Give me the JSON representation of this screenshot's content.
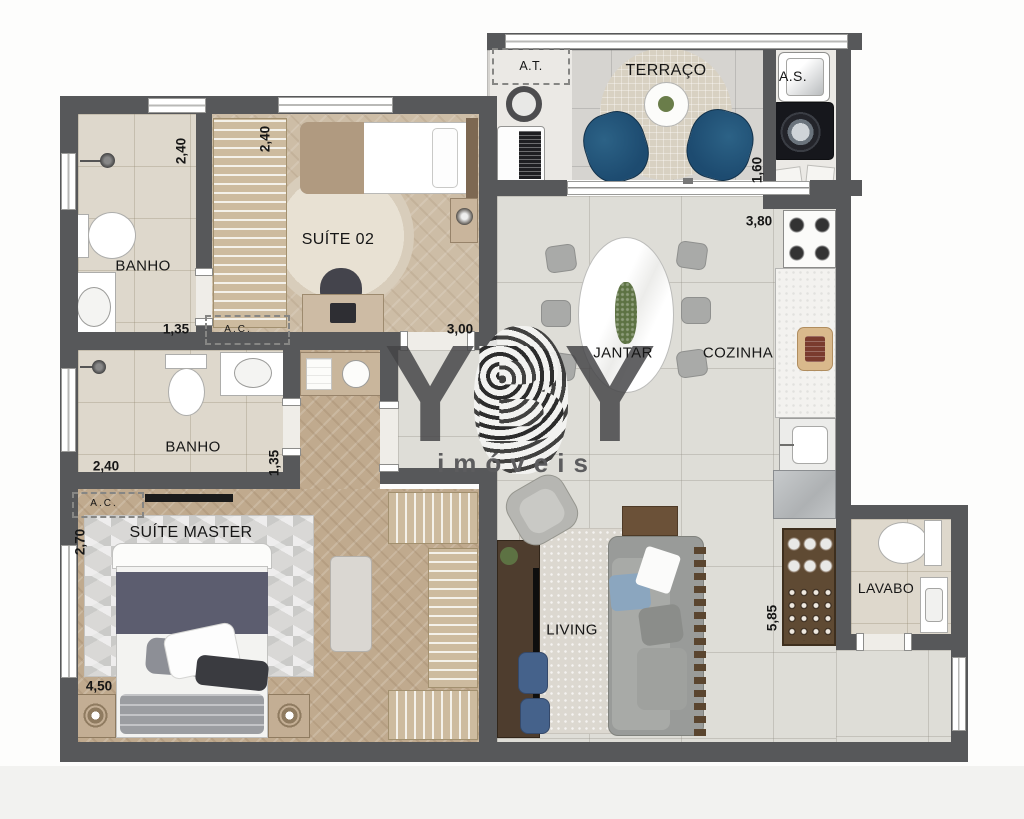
{
  "watermark": {
    "y1": "Y",
    "b": "B",
    "y2": "Y",
    "subtitle": "imóveis"
  },
  "rooms": {
    "banho1": "BANHO",
    "suite02": "SUÍTE 02",
    "terraco": "TERRAÇO",
    "area_tecnica": "A.T.",
    "area_servico": "A.S.",
    "jantar": "JANTAR",
    "cozinha": "COZINHA",
    "banho2": "BANHO",
    "ac1": "A.C.",
    "ac2": "A.C.",
    "suite_master": "SUÍTE MASTER",
    "living": "LIVING",
    "lavabo": "LAVABO"
  },
  "dimensions": {
    "banho1_width": "2,40",
    "suite02_closet_width": "2,40",
    "banho1_length": "1,35",
    "suite02_width": "3,00",
    "terraco_depth": "1,60",
    "cozinha_width": "3,80",
    "banho2_width": "2,40",
    "banho2_depth": "1,35",
    "suite_master_depth": "2,70",
    "suite_master_width": "4,50",
    "living_depth": "5,85"
  },
  "colors": {
    "wall": "#57585a",
    "wood_floor": "#c0aa8e",
    "main_tile": "#deddd7",
    "bath_tile": "#ded8cc",
    "terrace_chair_blue": "#1d4b70",
    "ottoman_blue": "#45628b",
    "bed_blanket": "#5c5d6f",
    "cabinet_wood": "#5f4a33",
    "watermark_gray": "#48484a"
  }
}
